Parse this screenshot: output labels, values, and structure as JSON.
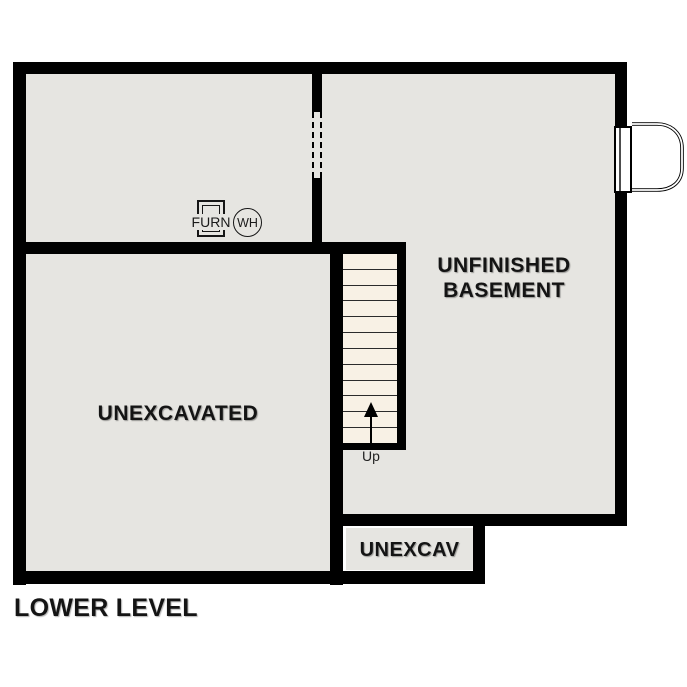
{
  "title": "LOWER LEVEL",
  "colors": {
    "wall": "#000000",
    "floor_fill": "#e6e5e1",
    "stair_fill": "#f8f1e5",
    "background": "#ffffff",
    "text": "#141414"
  },
  "rooms": {
    "unfinished_basement": {
      "label_line1": "UNFINISHED",
      "label_line2": "BASEMENT"
    },
    "unexcavated": {
      "label": "UNEXCAVATED"
    },
    "unexcav": {
      "label": "UNEXCAV"
    }
  },
  "equipment": {
    "furnace": {
      "label": "FURN"
    },
    "water_heater": {
      "label": "WH"
    }
  },
  "stairs": {
    "direction_label": "Up",
    "tread_count": 12
  },
  "features": {
    "dashed_wall_opening": "interior doorway opening (dashed)",
    "exterior_door": "basement exterior door with areaway at right wall"
  }
}
